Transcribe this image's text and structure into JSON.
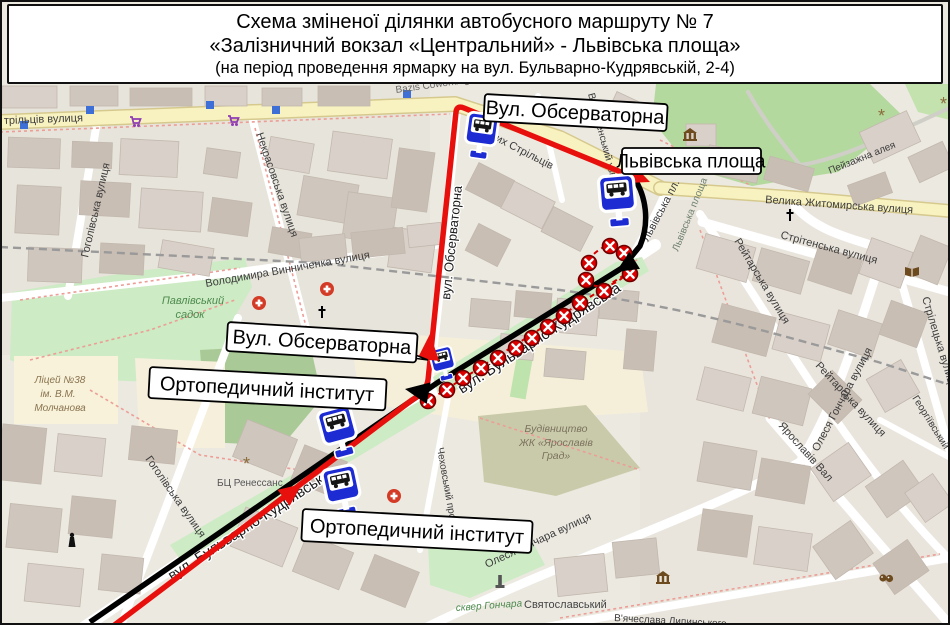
{
  "title": {
    "line1": "Схема зміненої ділянки автобусного маршруту № 7",
    "line2": "«Залізничний вокзал «Центральний» - Львівська площа»",
    "line3": "(на період проведення ярмарку на вул. Бульварно-Кудрявській, 2-4)"
  },
  "callouts": {
    "observatorna_top": "Вул. Обсерваторна",
    "lvivska_square": "Львівська площа",
    "observatorna_mid": "Вул. Обсерваторна",
    "orthopedic_top": "Ортопедичний інститут",
    "orthopedic_bottom": "Ортопедичний інститут"
  },
  "map_labels": {
    "striltsiv_partial": "трільців вулиця",
    "bazis": "Bazis Coworking",
    "sichovykh": "Січових Стрільців",
    "voznesensky": "Вознесенський узвіз",
    "lvivska_pl": "Львівська пл.",
    "lvivska_park": "Львівська площа",
    "zhytomyrska": "Велика Житомирська вулиця",
    "peizazhna": "Пейзажна алея",
    "stritenska": "Стрітенська вулиця",
    "reitarska_1": "Рейтарська вулиця",
    "reitarska_2": "Рейтарська вулиця",
    "honchara_right": "Олеся Гончара вулиця",
    "honchara_bottom": "Олеся Гончара вулиця",
    "striletska": "Стрілецька вулиця",
    "heorhiivsky": "Георгіївський",
    "yaroslaviv_val": "Ярославів Вал",
    "vynnychenka": "Володимира Винниченка вулиця",
    "nekrasovska": "Некрасовська вулиця",
    "hoholivska_top": "Гоголівська вулиця",
    "hoholivska_bottom": "Гоголівська вулиця",
    "pavlivsky_l1": "Павлівський",
    "pavlivsky_l2": "садок",
    "lyceum_l1": "Ліцей №38",
    "lyceum_l2": "ім. В.М.",
    "lyceum_l3": "Молчанова",
    "bts_renessans": "БЦ Ренессанс",
    "bud_l1": "Будівництво",
    "bud_l2": "ЖК «Ярославів",
    "bud_l3": "Град»",
    "chekhovsky": "Чеховський провулок",
    "skver_honchara": "сквер Гончара",
    "sviatoslavsky": "Святославський",
    "lypynskoho": "В'ячеслава Липинського",
    "bulvarno_1": "вул. Бульварно-Кудрявська",
    "bulvarno_2": "вул. Бульварно-Кудрявська",
    "observatorna_street": "вул. Обсерваторна"
  },
  "icons": {
    "bus_stop_sign": "blue-square-sign-with-bus-on-pole",
    "closed_stop_marker": "red-circle-white-x",
    "hospital": "red-circle-white-cross",
    "church": "black-cross",
    "supermarket": "purple-shopping-cart",
    "museum": "brown-classical-building",
    "library": "brown-open-book",
    "theatre": "brown-theatre-masks",
    "memorial": "black-statue",
    "monument": "gray-obelisk",
    "base_bus_stop": "small-blue-square"
  },
  "colors": {
    "route_red": "#e8100c",
    "route_black": "#000000",
    "closed_marker_red": "#dd0000",
    "bus_sign_blue": "#1d2bd3",
    "main_road_yellow": "#f8f2c0",
    "park_green": "#cdebc4",
    "dark_green": "#a9ca96",
    "building_gray": "#d9d0c9",
    "land": "#ece9e1",
    "construction_olive": "#c9caa9"
  }
}
